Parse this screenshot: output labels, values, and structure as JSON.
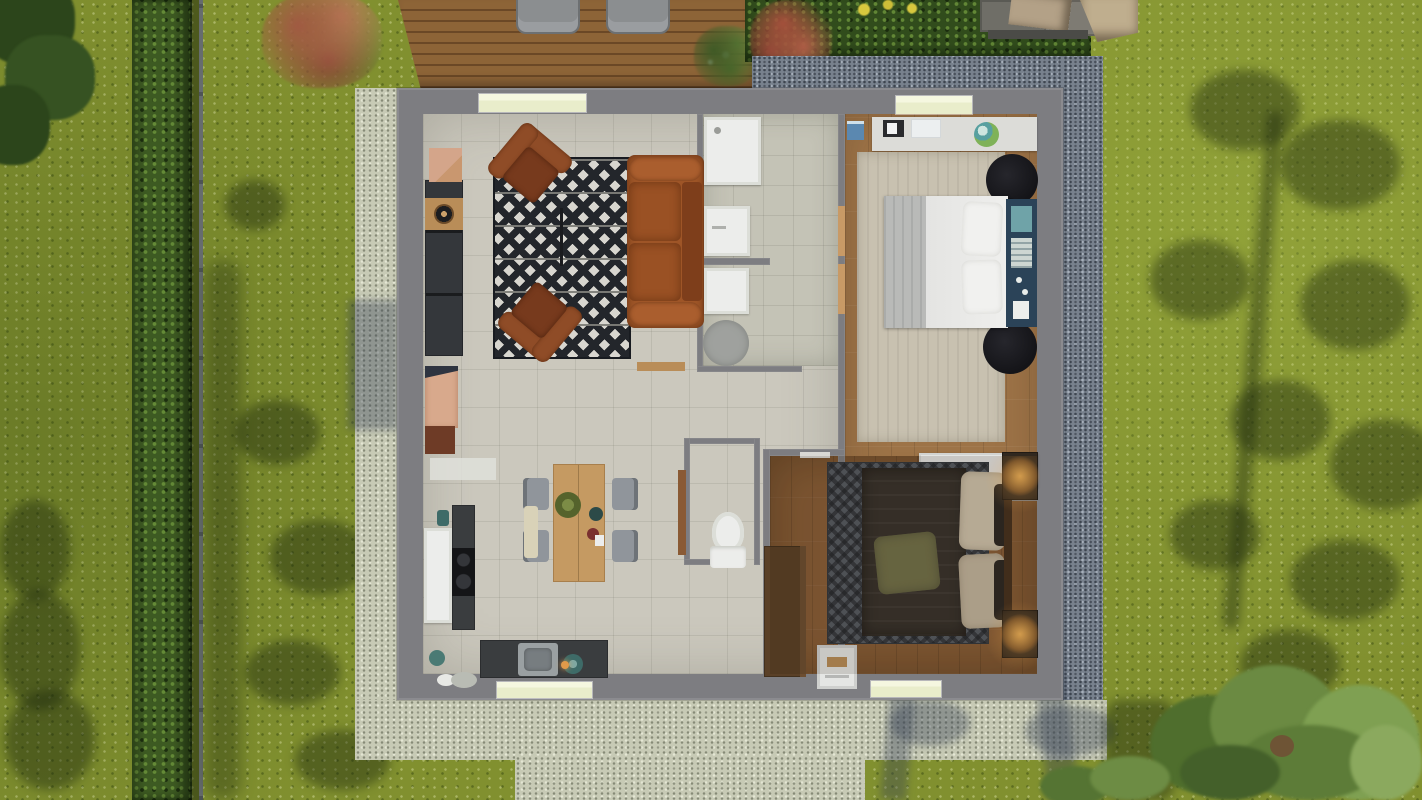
{
  "meta": {
    "title": "top-down-3d-floor-plan-render",
    "canvas": {
      "width": 1422,
      "height": 800
    }
  },
  "palette": {
    "grass": "#81902f",
    "hedge": "#3d5a22",
    "fence": "#666c6e",
    "deck": "#8d6437",
    "deckDark": "#6b4826",
    "lounger": "#8b8e90",
    "gravelDark": "#78818d",
    "gravelLight": "#c7cab5",
    "wall": "#7d7d81",
    "tile": "#cbc8bd",
    "bathTile": "#c4c3b6",
    "wood1": "#9d7347",
    "wood2": "#8a5f38",
    "sill": "#e9edcb",
    "sillLight": "#f5f7e0",
    "fixture": "#ecedeb",
    "sofa": "#9e5527",
    "sideboard": "#34373b",
    "woodAccent": "#b98d58",
    "rugBlack": "#23262b",
    "rugWhite": "#d8d6cf",
    "rugBlackRound": "#141418",
    "rugBeige": "#c8c1b0",
    "rugChevron": "#565b62",
    "counter": "#3a3d3f",
    "chairGray": "#90959b",
    "tableWood": "#c59a62",
    "headboard": "#2b4358",
    "headboardTeal": "#6fa3a8",
    "duvetDark": "#38332d",
    "pillowOlive": "#72714a",
    "pillowBeige": "#cfc3ac",
    "nightstand": "#31281f",
    "lampGlow": "#e8a04a",
    "wardrobe": "#5a4027",
    "doorWood": "#c89a66",
    "tentCanopy": "#bfae8e",
    "tentMat": "#6f6e67"
  },
  "environment": {
    "features": [
      "lawn",
      "hedge-row",
      "garden-fence",
      "tree-shadow",
      "autumn-shrub",
      "wood-deck",
      "sun-lounger",
      "sun-lounger",
      "deck-plant",
      "flowering-hedge",
      "red-flowers",
      "yellow-flowers",
      "garden-tent",
      "dark-gravel-border",
      "light-gravel-path",
      "gravel-patio",
      "corner-tree",
      "corner-foliage"
    ]
  },
  "house": {
    "rooms": [
      {
        "id": "living-room",
        "floor": "tile",
        "furniture": [
          "media-sideboard",
          "vinyl-record",
          "wall-shelf",
          "zigzag-rug",
          "armchair",
          "armchair",
          "leather-sofa",
          "floor-lamp",
          "side-bench",
          "entrance-cabinet",
          "doormat"
        ]
      },
      {
        "id": "bathroom",
        "floor": "tile",
        "furniture": [
          "shower-tray",
          "sink-vanity",
          "washing-machine",
          "round-rug"
        ]
      },
      {
        "id": "wc",
        "floor": "tile",
        "furniture": [
          "toilet",
          "door-leaf"
        ]
      },
      {
        "id": "kitchen-dining",
        "floor": "tile",
        "furniture": [
          "fridge",
          "cooktop",
          "kettle",
          "sink-counter",
          "counter",
          "teal-plate",
          "candle",
          "jar",
          "floor-mat",
          "dining-table",
          "dining-chair",
          "dining-chair",
          "dining-chair",
          "dining-chair",
          "bench",
          "green-plate",
          "bowl",
          "bowl"
        ]
      },
      {
        "id": "bedroom-1",
        "floor": "wood",
        "furniture": [
          "desk",
          "laptop",
          "papers",
          "globe",
          "storage-bin",
          "area-rug",
          "double-bed",
          "gray-blanket",
          "pillow",
          "pillow",
          "headboard",
          "round-rug",
          "round-rug",
          "dresser",
          "door-threshold",
          "door-threshold"
        ]
      },
      {
        "id": "bedroom-2",
        "floor": "wood",
        "furniture": [
          "chevron-rug",
          "double-bed",
          "olive-pillow",
          "beige-pillow",
          "beige-pillow",
          "headboard",
          "nightstand",
          "nightstand",
          "table-lamp",
          "table-lamp",
          "wardrobe",
          "step-stool",
          "door-leaf"
        ]
      }
    ]
  }
}
